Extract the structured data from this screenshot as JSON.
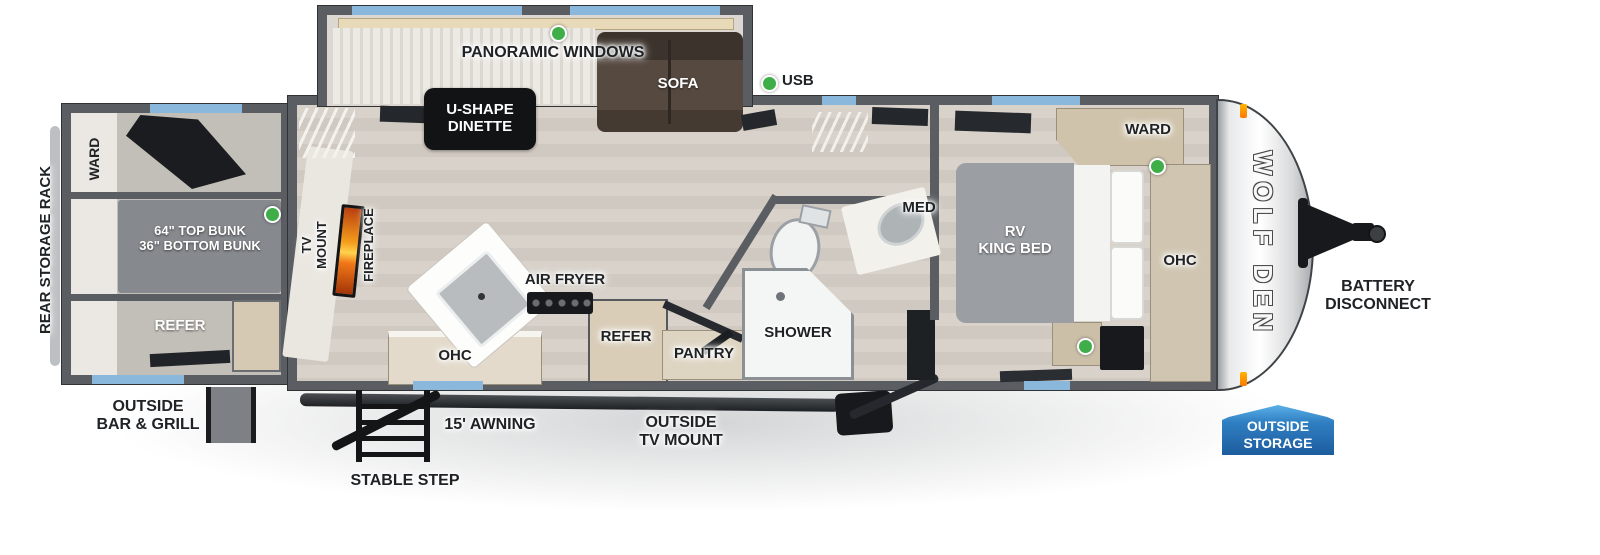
{
  "labels": {
    "slideout": {
      "panoramic_windows": "PANORAMIC WINDOWS",
      "dinette": "U-SHAPE\nDINETTE",
      "sofa": "SOFA"
    },
    "living": {
      "usb": "USB",
      "tv_mount": "TV\nMOUNT",
      "fireplace": "FIREPLACE"
    },
    "kitchen": {
      "air_fryer": "AIR FRYER",
      "ohc": "OHC",
      "refer": "REFER",
      "pantry": "PANTRY"
    },
    "bathroom": {
      "shower": "SHOWER",
      "med": "MED"
    },
    "bedroom": {
      "bed": "RV\nKING BED",
      "ward": "WARD",
      "ohc": "OHC"
    },
    "bunkroom": {
      "rear_storage_rack": "REAR STORAGE RACK",
      "ward": "WARD",
      "bunks": "64\" TOP BUNK\n36\" BOTTOM BUNK",
      "refer": "REFER"
    },
    "exterior": {
      "outside_bar_grill": "OUTSIDE\nBAR & GRILL",
      "stable_step": "STABLE STEP",
      "awning": "15' AWNING",
      "outside_tv_mount": "OUTSIDE\nTV MOUNT",
      "battery_disconnect": "BATTERY\nDISCONNECT",
      "outside_storage": "OUTSIDE\nSTORAGE",
      "brand": "WOLF DEN"
    }
  },
  "colors": {
    "wall": "#5a5e62",
    "window": "#8ab7dc",
    "floor": "#d5cfc7",
    "usb_indicator": "#3fae49",
    "fireplace": "#f07818",
    "storage_badge": "#2e7fc2",
    "sofa": "#4a3f37",
    "bed": "#9b9ea3",
    "cabinet": "#d3c8b2"
  }
}
